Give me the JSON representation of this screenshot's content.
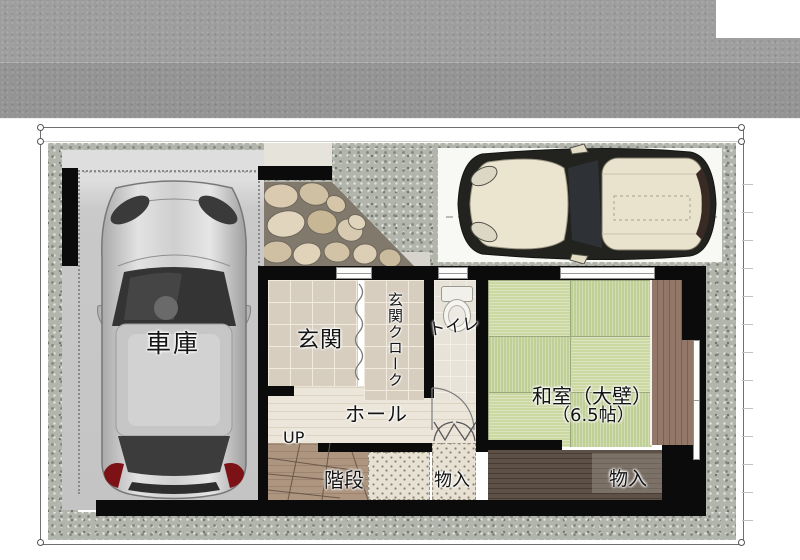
{
  "floorplan": {
    "title": "1F plan perspective",
    "rooms": {
      "garage": {
        "label": "車庫"
      },
      "entrance": {
        "label": "玄関"
      },
      "entrance_cloak": {
        "label": "玄関クローク"
      },
      "toilet": {
        "label": "トイレ"
      },
      "hall": {
        "label": "ホール"
      },
      "stairs": {
        "label": "階段",
        "direction_label": "UP"
      },
      "storage_hall": {
        "label": "物入"
      },
      "washitsu": {
        "label_line1": "和室（大壁）",
        "label_line2": "（6.5帖）"
      },
      "storage_washitsu": {
        "label": "物入"
      }
    },
    "colors": {
      "road_gray": "#9e9e9e",
      "gravel_gray": "#b2b5ac",
      "garage_pad": "#c9c9c9",
      "tile_beige": "#d7cec0",
      "hall_wood": "#ece6da",
      "stair_wood": "#ad957f",
      "tatami_green_light": "#ccd8a2",
      "tatami_green_dark": "#c0cf95",
      "closet_wood_dark": "#5d5046",
      "engawa_wood": "#93786a",
      "wall_black": "#0b0b0b",
      "car_silver": "#cfcfcf",
      "car_cream": "#e9e2cc"
    }
  }
}
